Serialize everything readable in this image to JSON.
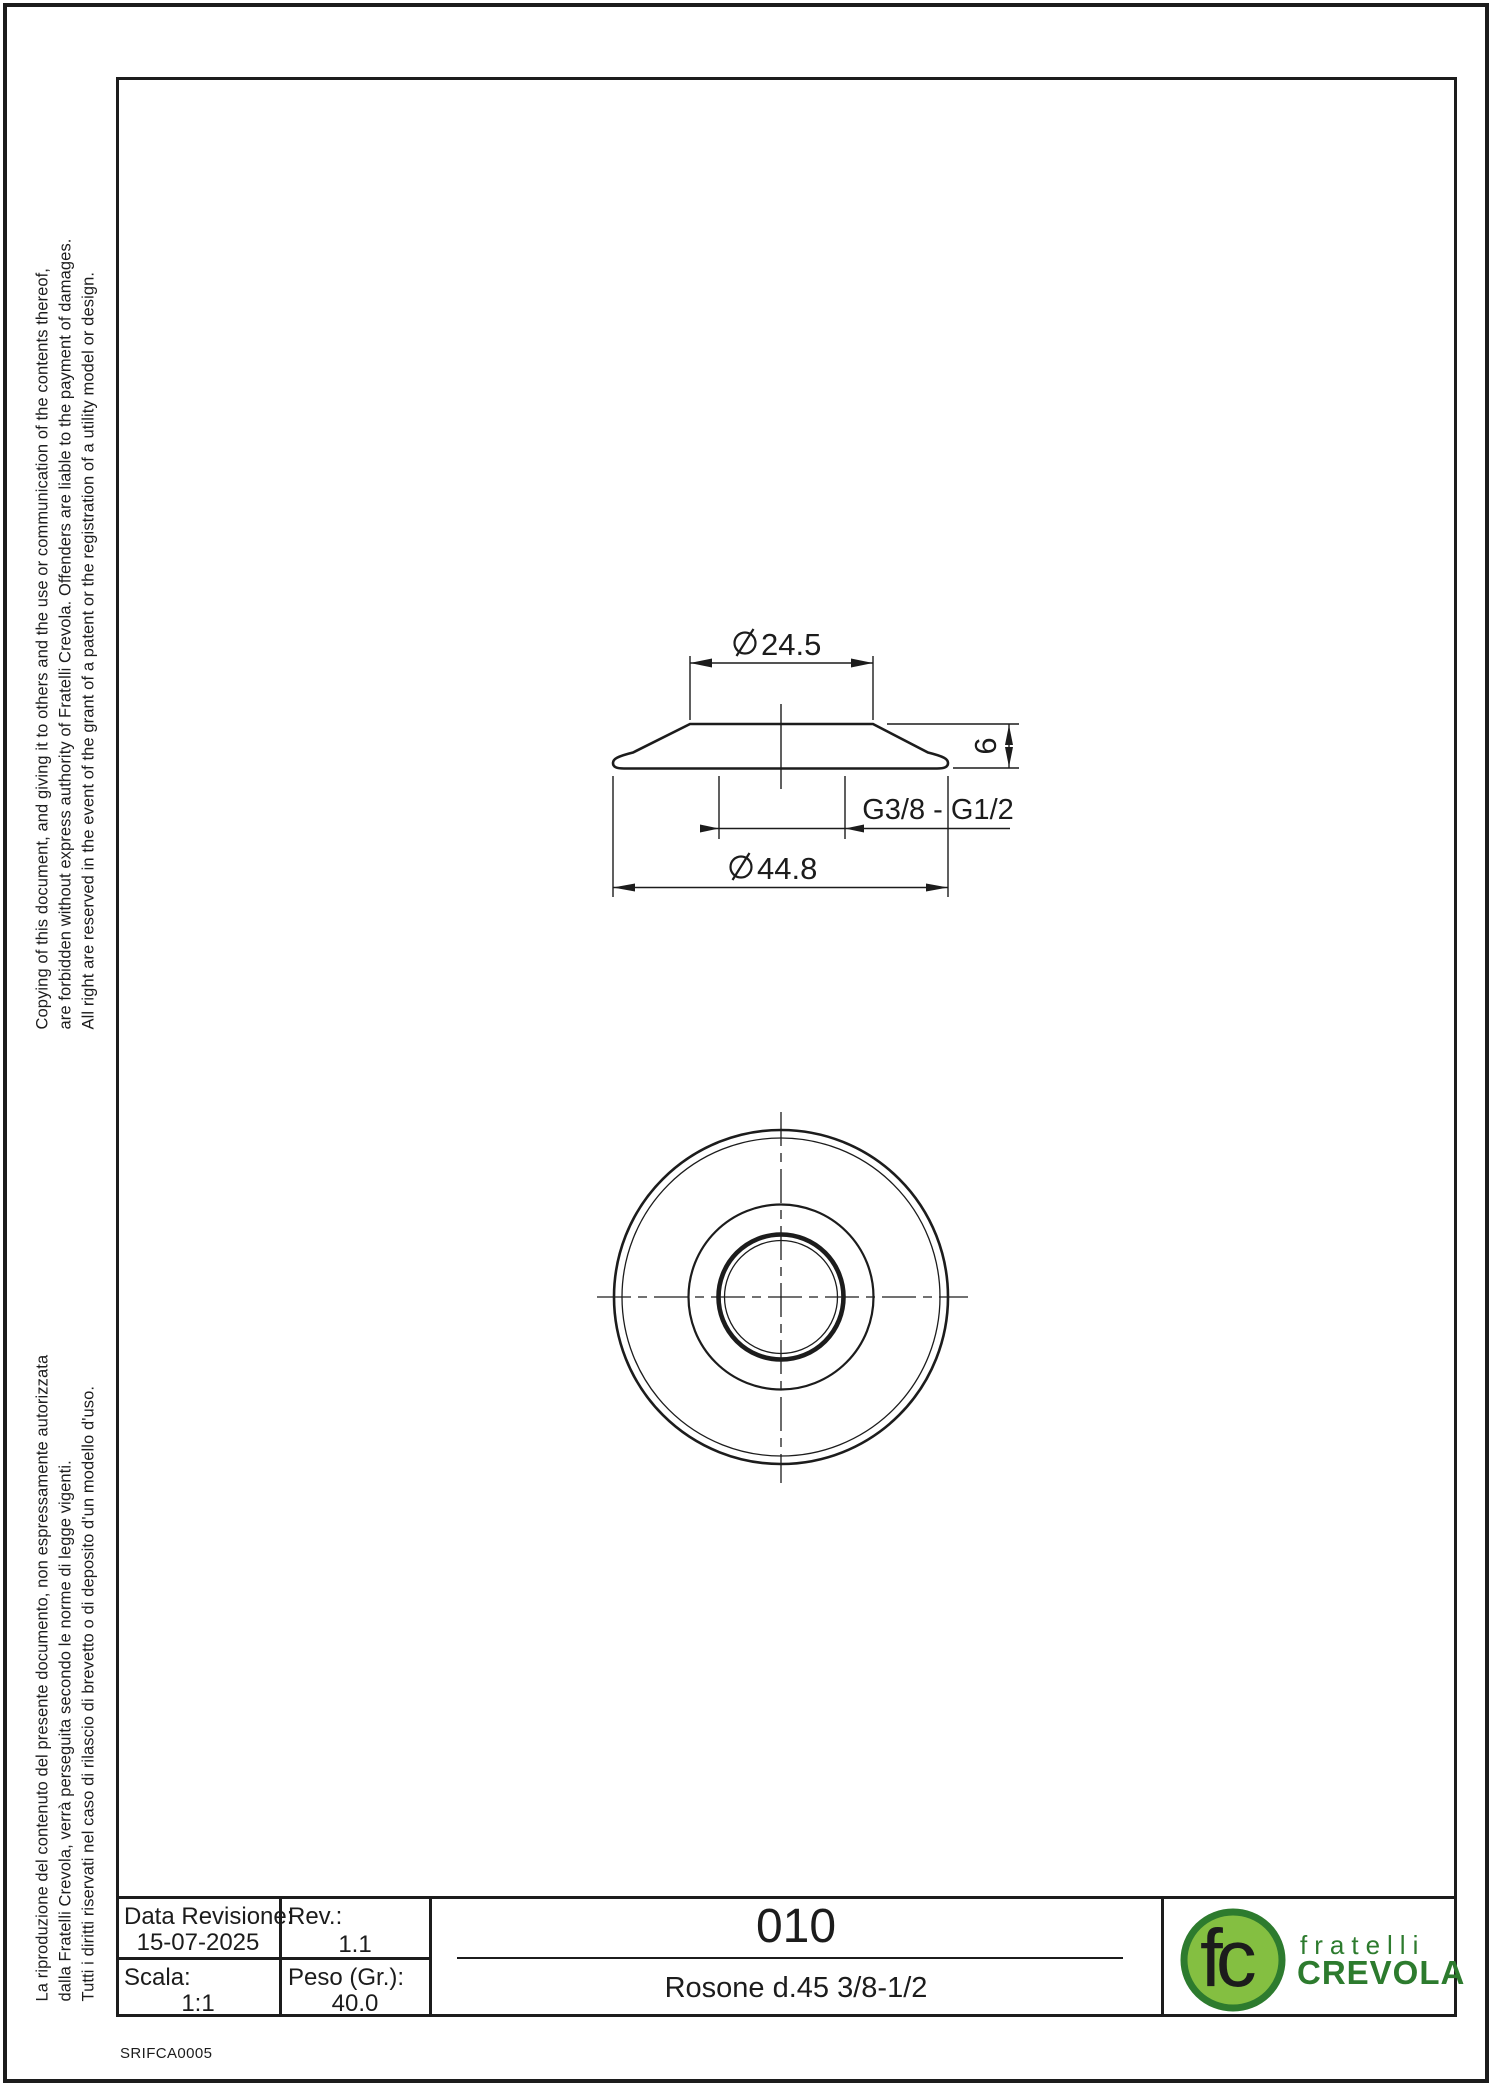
{
  "colors": {
    "ink": "#1c1c1c",
    "background": "#ffffff",
    "logo_ring_green": "#2d7b2e",
    "logo_fill_green": "#84bf41",
    "logo_text_green": "#2d7b2e"
  },
  "margin_notes": {
    "english": [
      "Copying of this document, and giving it to others and the use or communication of the contents thereof,",
      "are forbidden without express authority of Fratelli Crevola. Offenders are liable to the payment of damages.",
      "All right are reserved in the event of the grant of a patent or the registration of a utility model or design."
    ],
    "italian": [
      "La riproduzione del contenuto del presente documento, non espressamente autorizzata",
      "dalla Fratelli Crevola, verrà perseguita secondo le norme di legge vigenti.",
      "Tutti i diritti riservati nel caso di rilascio di brevetto o di deposito d'un modello d'uso."
    ]
  },
  "drawing": {
    "side_view": {
      "top_diameter": "24.5",
      "bottom_diameter": "44.8",
      "height": "6",
      "thread_spec": "G3/8 - G1/2"
    }
  },
  "title_block": {
    "data_revisione_label": "Data Revisione:",
    "data_revisione_value": "15-07-2025",
    "rev_label": "Rev.:",
    "rev_value": "1.1",
    "scala_label": "Scala:",
    "scala_value": "1:1",
    "peso_label": "Peso (Gr.):",
    "peso_value": "40.0",
    "part_number": "010",
    "part_description": "Rosone d.45 3/8-1/2"
  },
  "logo": {
    "monogram": "fc",
    "name_line1": "fratelli",
    "name_line2": "CREVOLA"
  },
  "footer_code": "SRIFCA0005"
}
